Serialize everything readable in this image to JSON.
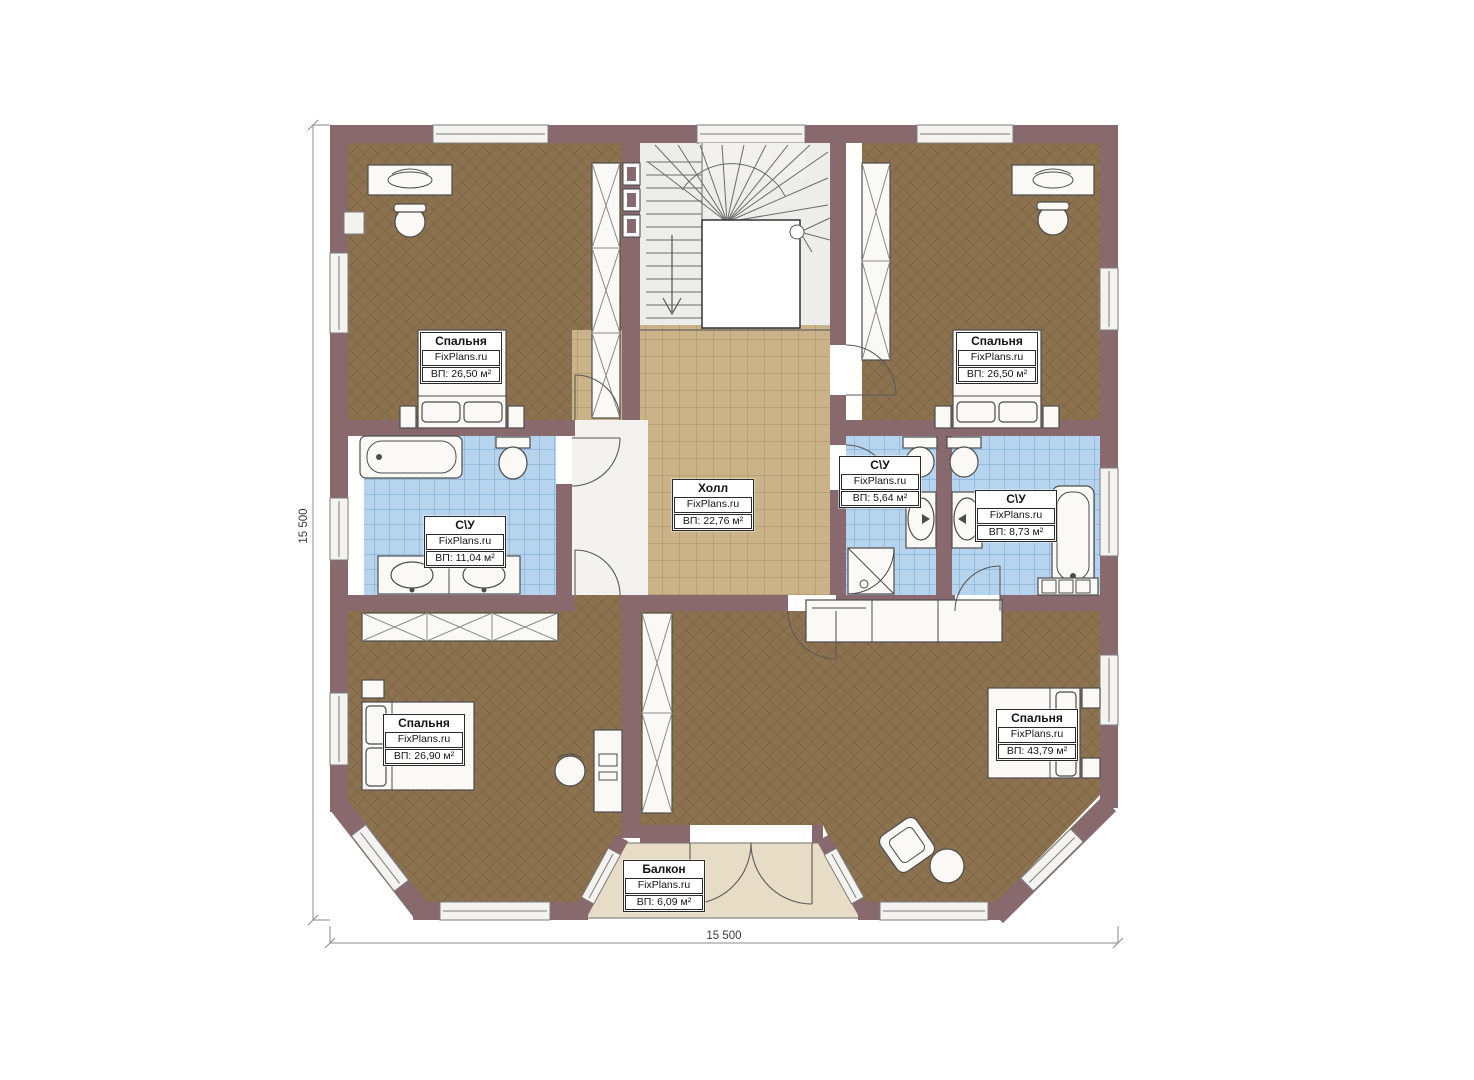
{
  "plan": {
    "rooms": [
      {
        "id": "bedroom-top-left",
        "name": "Спальня",
        "brand": "FixPlans.ru",
        "area": "ВП: 26,50 м²"
      },
      {
        "id": "bedroom-top-right",
        "name": "Спальня",
        "brand": "FixPlans.ru",
        "area": "ВП: 26,50 м²"
      },
      {
        "id": "hall",
        "name": "Холл",
        "brand": "FixPlans.ru",
        "area": "ВП: 22,76 м²"
      },
      {
        "id": "bathroom-left",
        "name": "С\\У",
        "brand": "FixPlans.ru",
        "area": "ВП: 11,04 м²"
      },
      {
        "id": "bathroom-middle",
        "name": "С\\У",
        "brand": "FixPlans.ru",
        "area": "ВП: 5,64 м²"
      },
      {
        "id": "bathroom-right",
        "name": "С\\У",
        "brand": "FixPlans.ru",
        "area": "ВП: 8,73 м²"
      },
      {
        "id": "bedroom-bottom-left",
        "name": "Спальня",
        "brand": "FixPlans.ru",
        "area": "ВП: 26,90 м²"
      },
      {
        "id": "bedroom-bottom-right",
        "name": "Спальня",
        "brand": "FixPlans.ru",
        "area": "ВП: 43,79 м²"
      },
      {
        "id": "balcony",
        "name": "Балкон",
        "brand": "FixPlans.ru",
        "area": "ВП: 6,09 м²"
      }
    ],
    "dimensions": {
      "width": "15 500",
      "height": "15 500"
    },
    "colors": {
      "wall": "#87696e",
      "bedroom_floor": "#8c724f",
      "bathroom_tile": "#b6d4ee",
      "hall_tile": "#cab289",
      "balcony_floor": "#e7dcc6"
    }
  }
}
